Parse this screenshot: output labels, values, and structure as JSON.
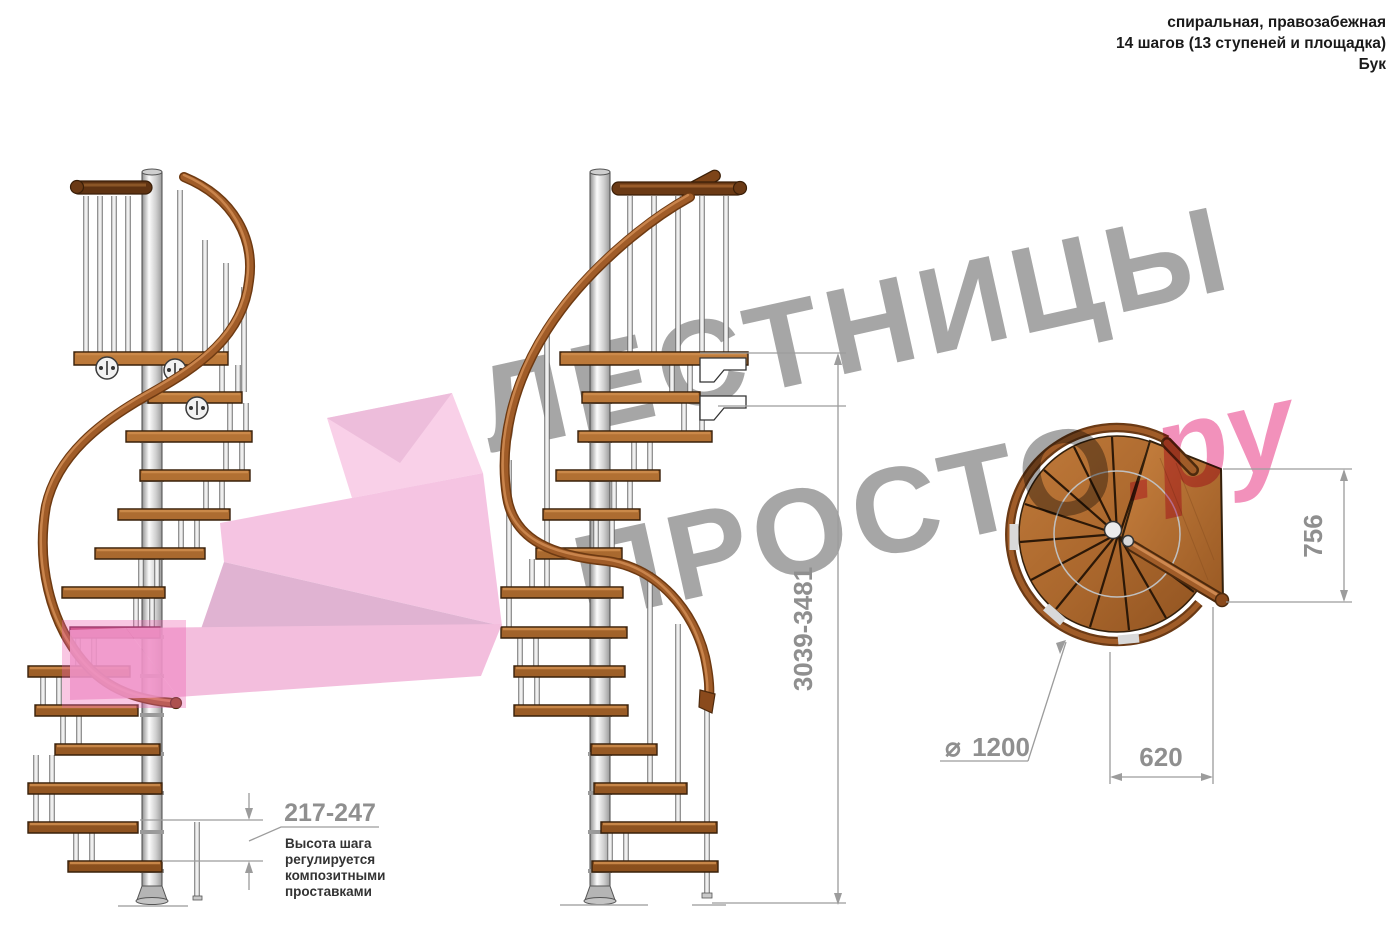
{
  "header": {
    "line1": "спиральная, правозабежная",
    "line2": "14 шагов (13 ступеней и площадка)",
    "line3": "Бук"
  },
  "watermark": {
    "line1": "ЛЕСТНИЦЫ",
    "line2_gray": "ПРОСТО",
    "line2_pink": ".ру",
    "gray_color": "#a6a6a6",
    "pink_color": "#f291bb"
  },
  "dimensions": {
    "total_height": "3039-3481",
    "step_rise": "217-247",
    "landing_depth": "756",
    "landing_width": "620",
    "diameter_symbol": "⌀",
    "diameter_value": "1200"
  },
  "note": {
    "lines": [
      "Высота шага",
      "регулируется",
      "композитными",
      "проставками"
    ]
  },
  "stair": {
    "steps_total": 14,
    "treads": 13,
    "material": "Бук"
  },
  "colors": {
    "wood": "#a9662c",
    "wood_dark": "#6e3a12",
    "rail_brown": "#8a4a1c",
    "metal_pole": "#d9d9d9",
    "dimension_gray": "#9c9c9c",
    "arrow_pink": "#f4bade",
    "highlight_magenta": "#ef5fae",
    "text_black": "#1a1a1a"
  }
}
